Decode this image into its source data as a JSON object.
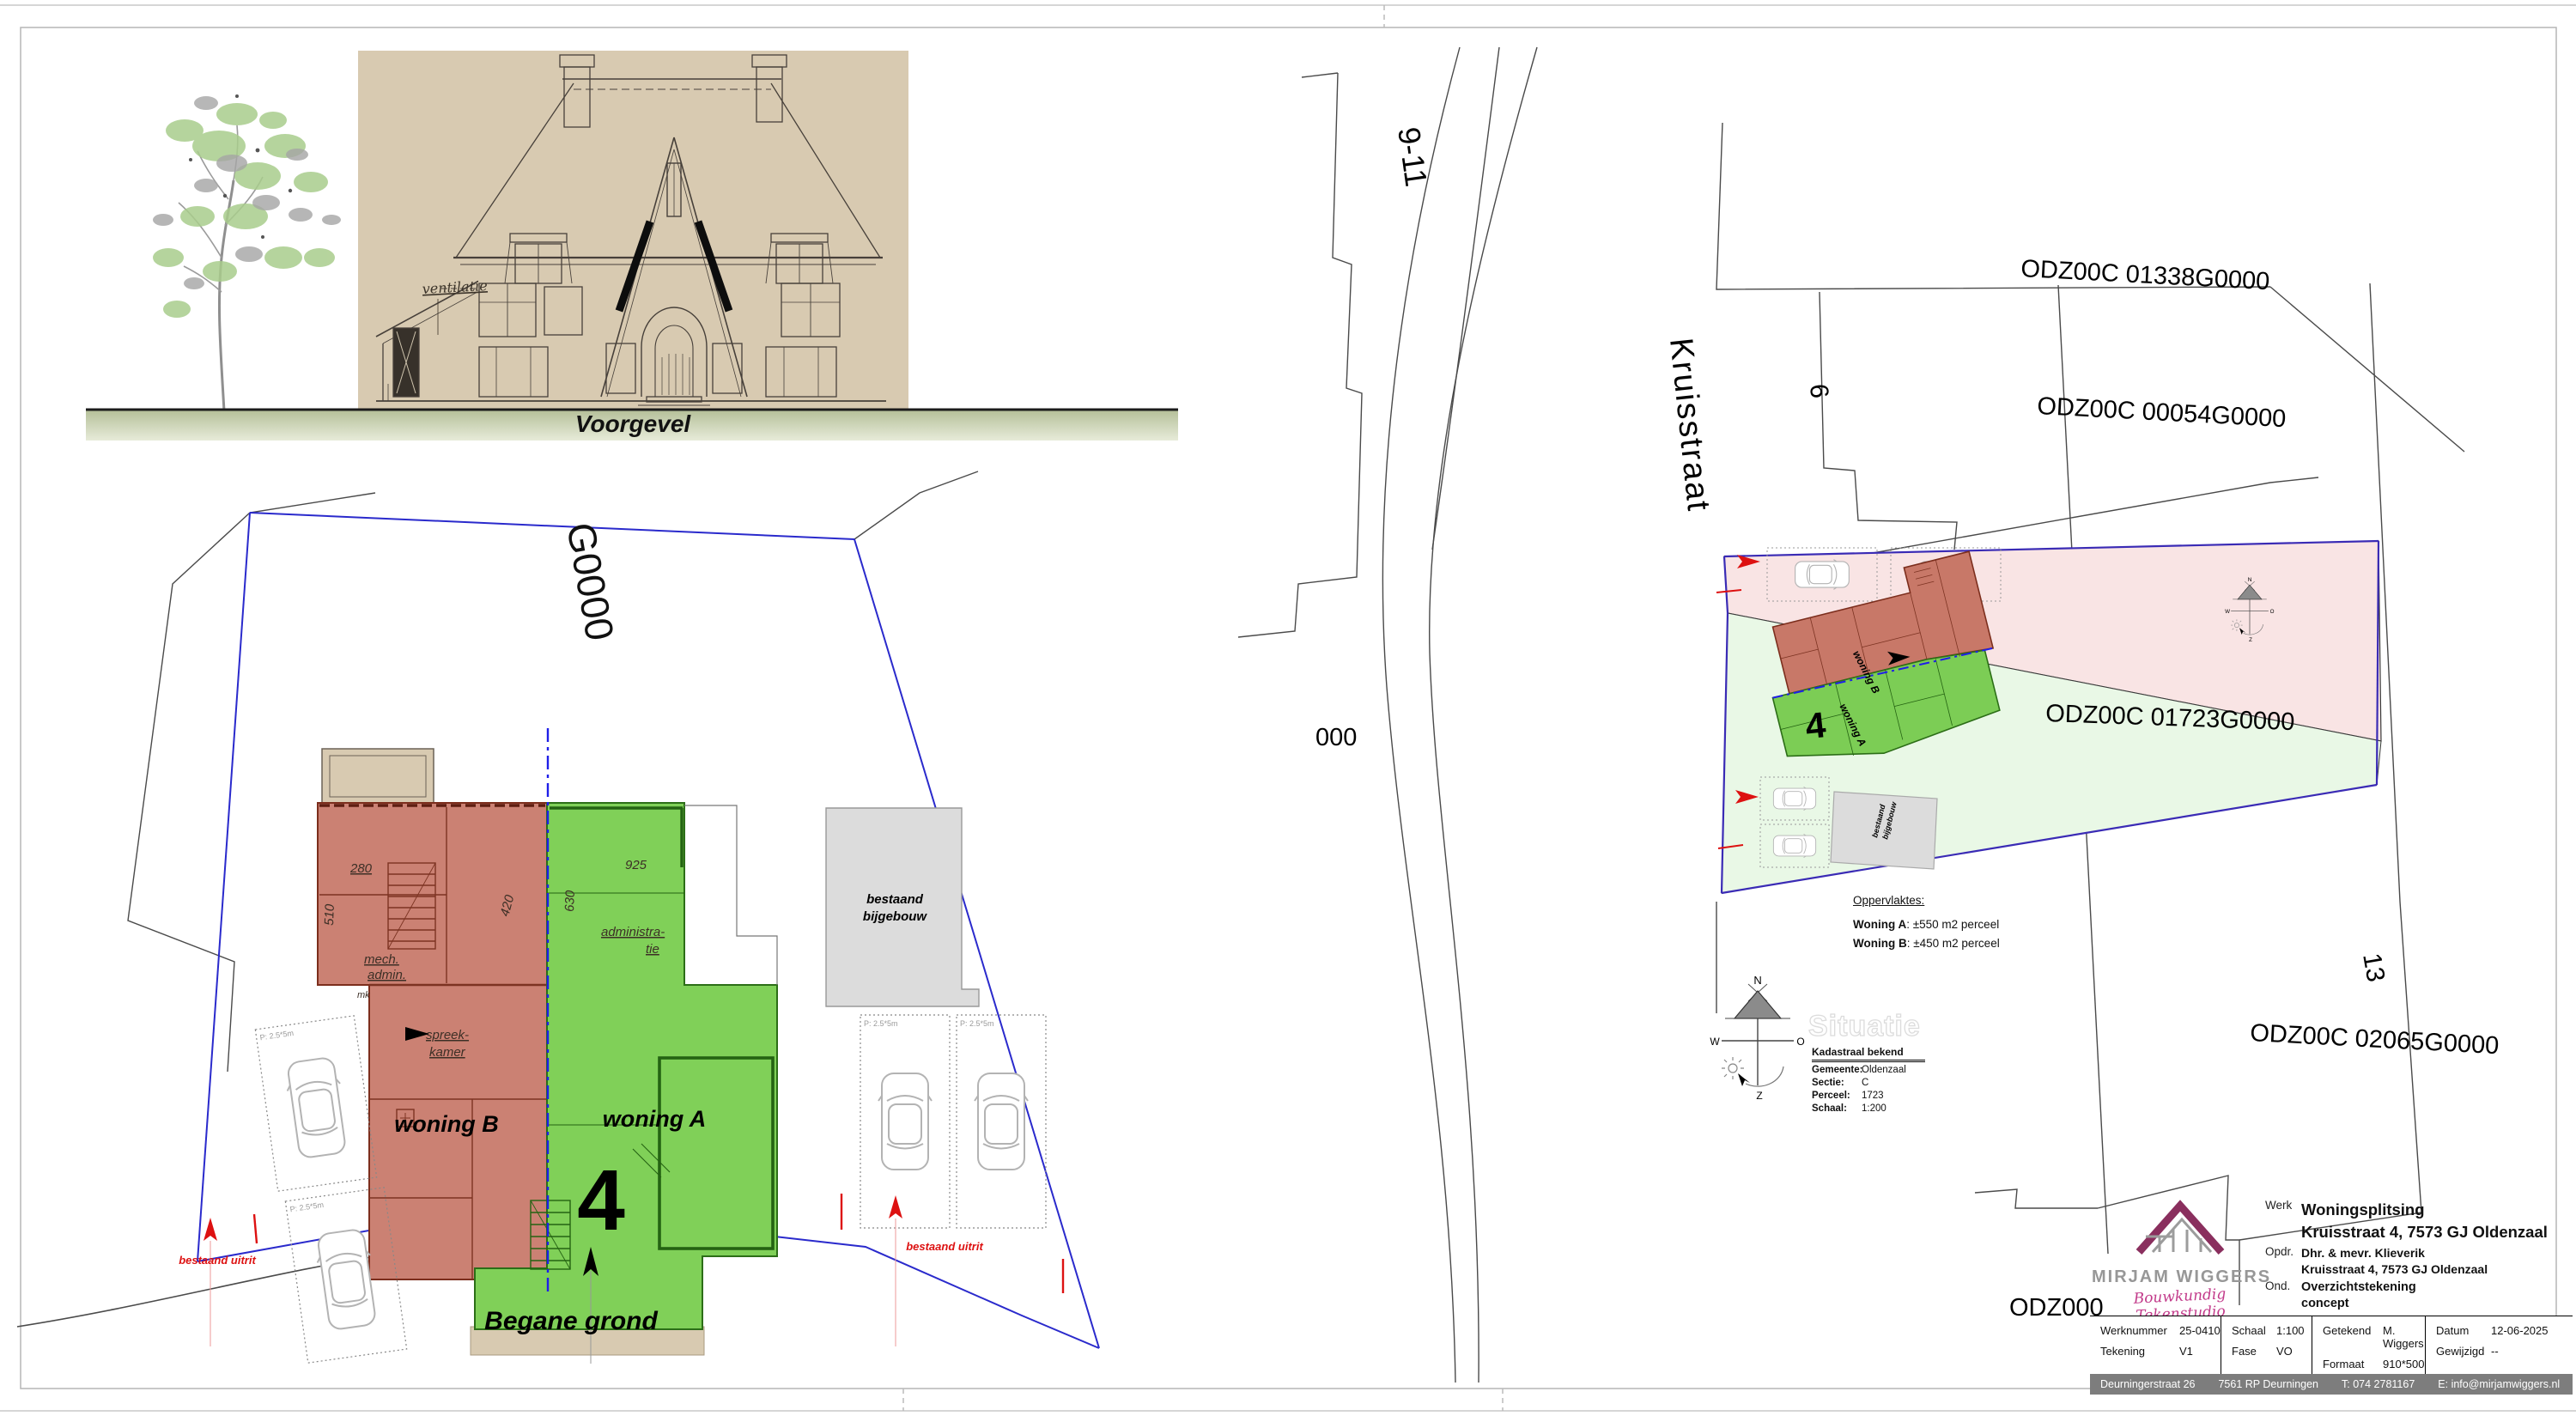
{
  "elevation": {
    "title": "Voorgevel",
    "ventilatie": "ventilatie"
  },
  "floor_plan": {
    "title": "Begane grond",
    "woning_a": "woning A",
    "woning_b": "woning B",
    "house_number": "4",
    "partial_parcel_label": "G0000",
    "dims": {
      "d280": "280",
      "d510": "510",
      "d925": "925",
      "d420": "420",
      "d630": "630"
    },
    "rooms": {
      "mech_line1": "mech.",
      "mech_line2": "admin.",
      "spreek_line1": "spreek-",
      "spreek_line2": "kamer",
      "admin_line1": "administra-",
      "admin_line2": "tie",
      "mk": "mk"
    },
    "bijgebouw_line1": "bestaand",
    "bijgebouw_line2": "bijgebouw",
    "bestaand_uitrit": "bestaand uitrit",
    "parking_size": "P: 2.5*5m"
  },
  "site_plan": {
    "street": "Kruisstraat",
    "house_9_11": "9-11",
    "house_6": "6",
    "house_13": "13",
    "parcels": [
      "ODZ00C 01338G0000",
      "ODZ00C 00054G0000",
      "ODZ00C 01723G0000",
      "ODZ00C 02065G0000"
    ],
    "partial_label_left": "000",
    "partial_label_bottom": "ODZ000",
    "situatie_title": "Situatie",
    "woning_a": "woning A",
    "woning_b": "woning B",
    "house_number": "4",
    "bijgebouw_line1": "bestaand",
    "bijgebouw_line2": "bijgebouw",
    "bestaand_uitrit": "bestaand uitrit",
    "oppervlaktes": {
      "title": "Oppervlaktes:",
      "rows": [
        {
          "label": "Woning A",
          "value": ": ±550 m2 perceel"
        },
        {
          "label": "Woning B",
          "value": ": ±450 m2 perceel"
        }
      ]
    },
    "kadastraal": {
      "title": "Kadastraal bekend",
      "rows": [
        {
          "label": "Gemeente:",
          "value": "Oldenzaal"
        },
        {
          "label": "Sectie:",
          "value": "C"
        },
        {
          "label": "Perceel:",
          "value": "1723"
        },
        {
          "label": "Schaal:",
          "value": "1:200"
        }
      ]
    },
    "compass": {
      "n": "N",
      "w": "W",
      "o": "O",
      "z": "Z"
    }
  },
  "title_block": {
    "brand": {
      "name": "MIRJAM WIGGERS",
      "tagline": "Bouwkundig Tekenstudio"
    },
    "werk_label": "Werk",
    "werk_line1": "Woningsplitsing",
    "werk_line2": "Kruisstraat 4, 7573 GJ Oldenzaal",
    "opdr_label": "Opdr.",
    "opdr_line1": "Dhr. & mevr. Klieverik",
    "opdr_line2": "Kruisstraat 4, 7573 GJ Oldenzaal",
    "ond_label": "Ond.",
    "ond_line1": "Overzichtstekening",
    "ond_line2": "concept",
    "fields": [
      {
        "label": "Werknummer",
        "value": "25-0410"
      },
      {
        "label": "Tekening",
        "value": "V1"
      },
      {
        "label": "Schaal",
        "value": "1:100"
      },
      {
        "label": "Fase",
        "value": "VO"
      },
      {
        "label": "Getekend",
        "value": "M. Wiggers"
      },
      {
        "label": "Formaat",
        "value": "910*500"
      },
      {
        "label": "Datum",
        "value": "12-06-2025"
      },
      {
        "label": "Gewijzigd",
        "value": "--"
      }
    ],
    "footer_items": [
      "Deurningerstraat 26",
      "7561 RP Deurningen",
      "T: 074 2781167",
      "E: info@mirjamwiggers.nl",
      "www.mirjamwiggers.nl"
    ]
  },
  "colors": {
    "woning_a_fill": "#80d058",
    "woning_b_fill": "#cb8173",
    "parcel_pink": "#f9e4e4",
    "parcel_green": "#e9f8e6",
    "boundary_blue": "#2a2acc",
    "annotation_red": "#dd1111",
    "scan_beige": "#d8cab1",
    "brand_magenta": "#c23a8a",
    "brand_gray": "#979797"
  }
}
